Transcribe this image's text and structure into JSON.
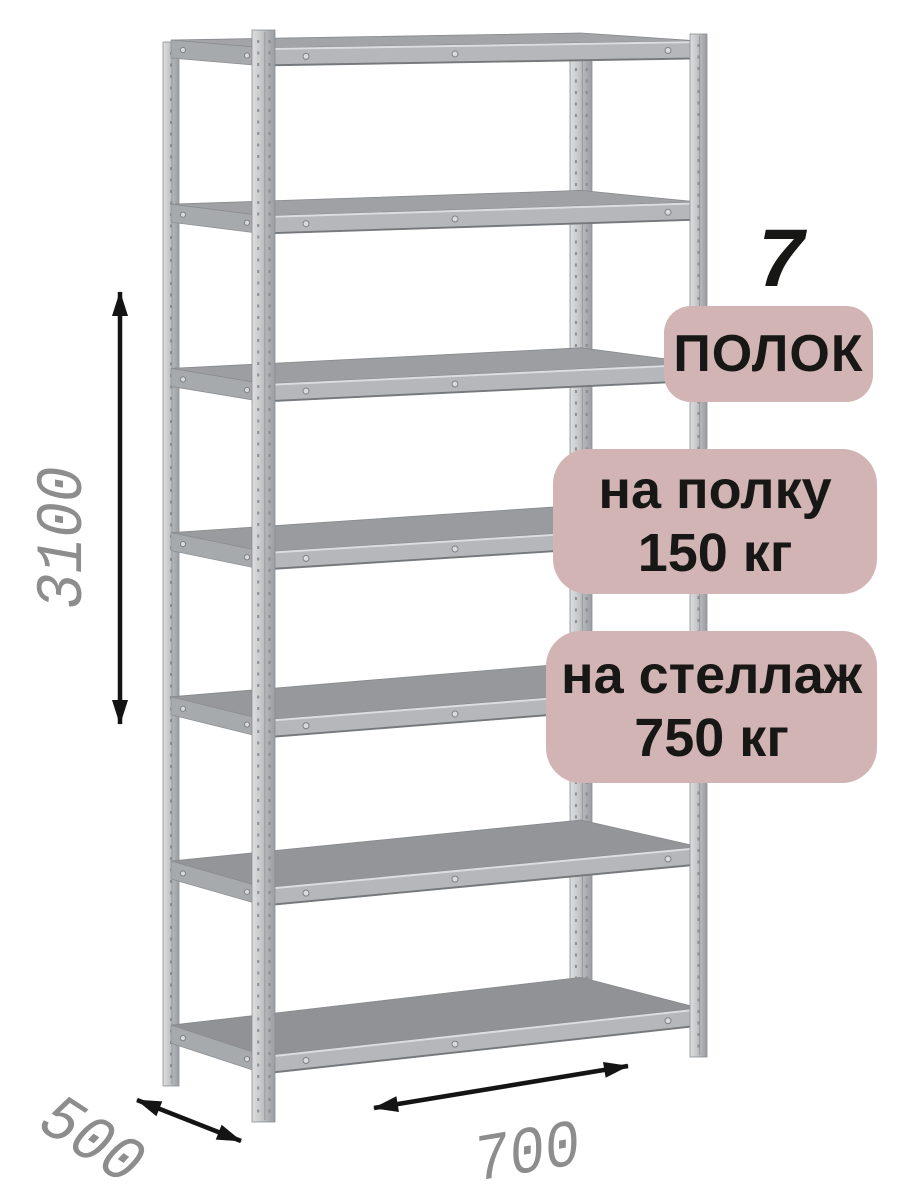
{
  "rack": {
    "shelf_count": 7
  },
  "badges": {
    "count_number": "7",
    "count_label": "ПОЛОК",
    "per_shelf_line1": "на полку",
    "per_shelf_line2": "150 кг",
    "per_rack_line1": "на стеллаж",
    "per_rack_line2": "750 кг"
  },
  "dimensions": {
    "height_mm": "3100",
    "depth_mm": "500",
    "width_mm": "700"
  },
  "colors": {
    "badge_bg": "#d3b4b4",
    "badge_text": "#171715",
    "dimension_text": "#8d8d8d",
    "arrow": "#141414",
    "background": "#ffffff",
    "metal_light": "#dcdee0",
    "metal_mid": "#a8abae",
    "metal_dark": "#9a9da1"
  }
}
